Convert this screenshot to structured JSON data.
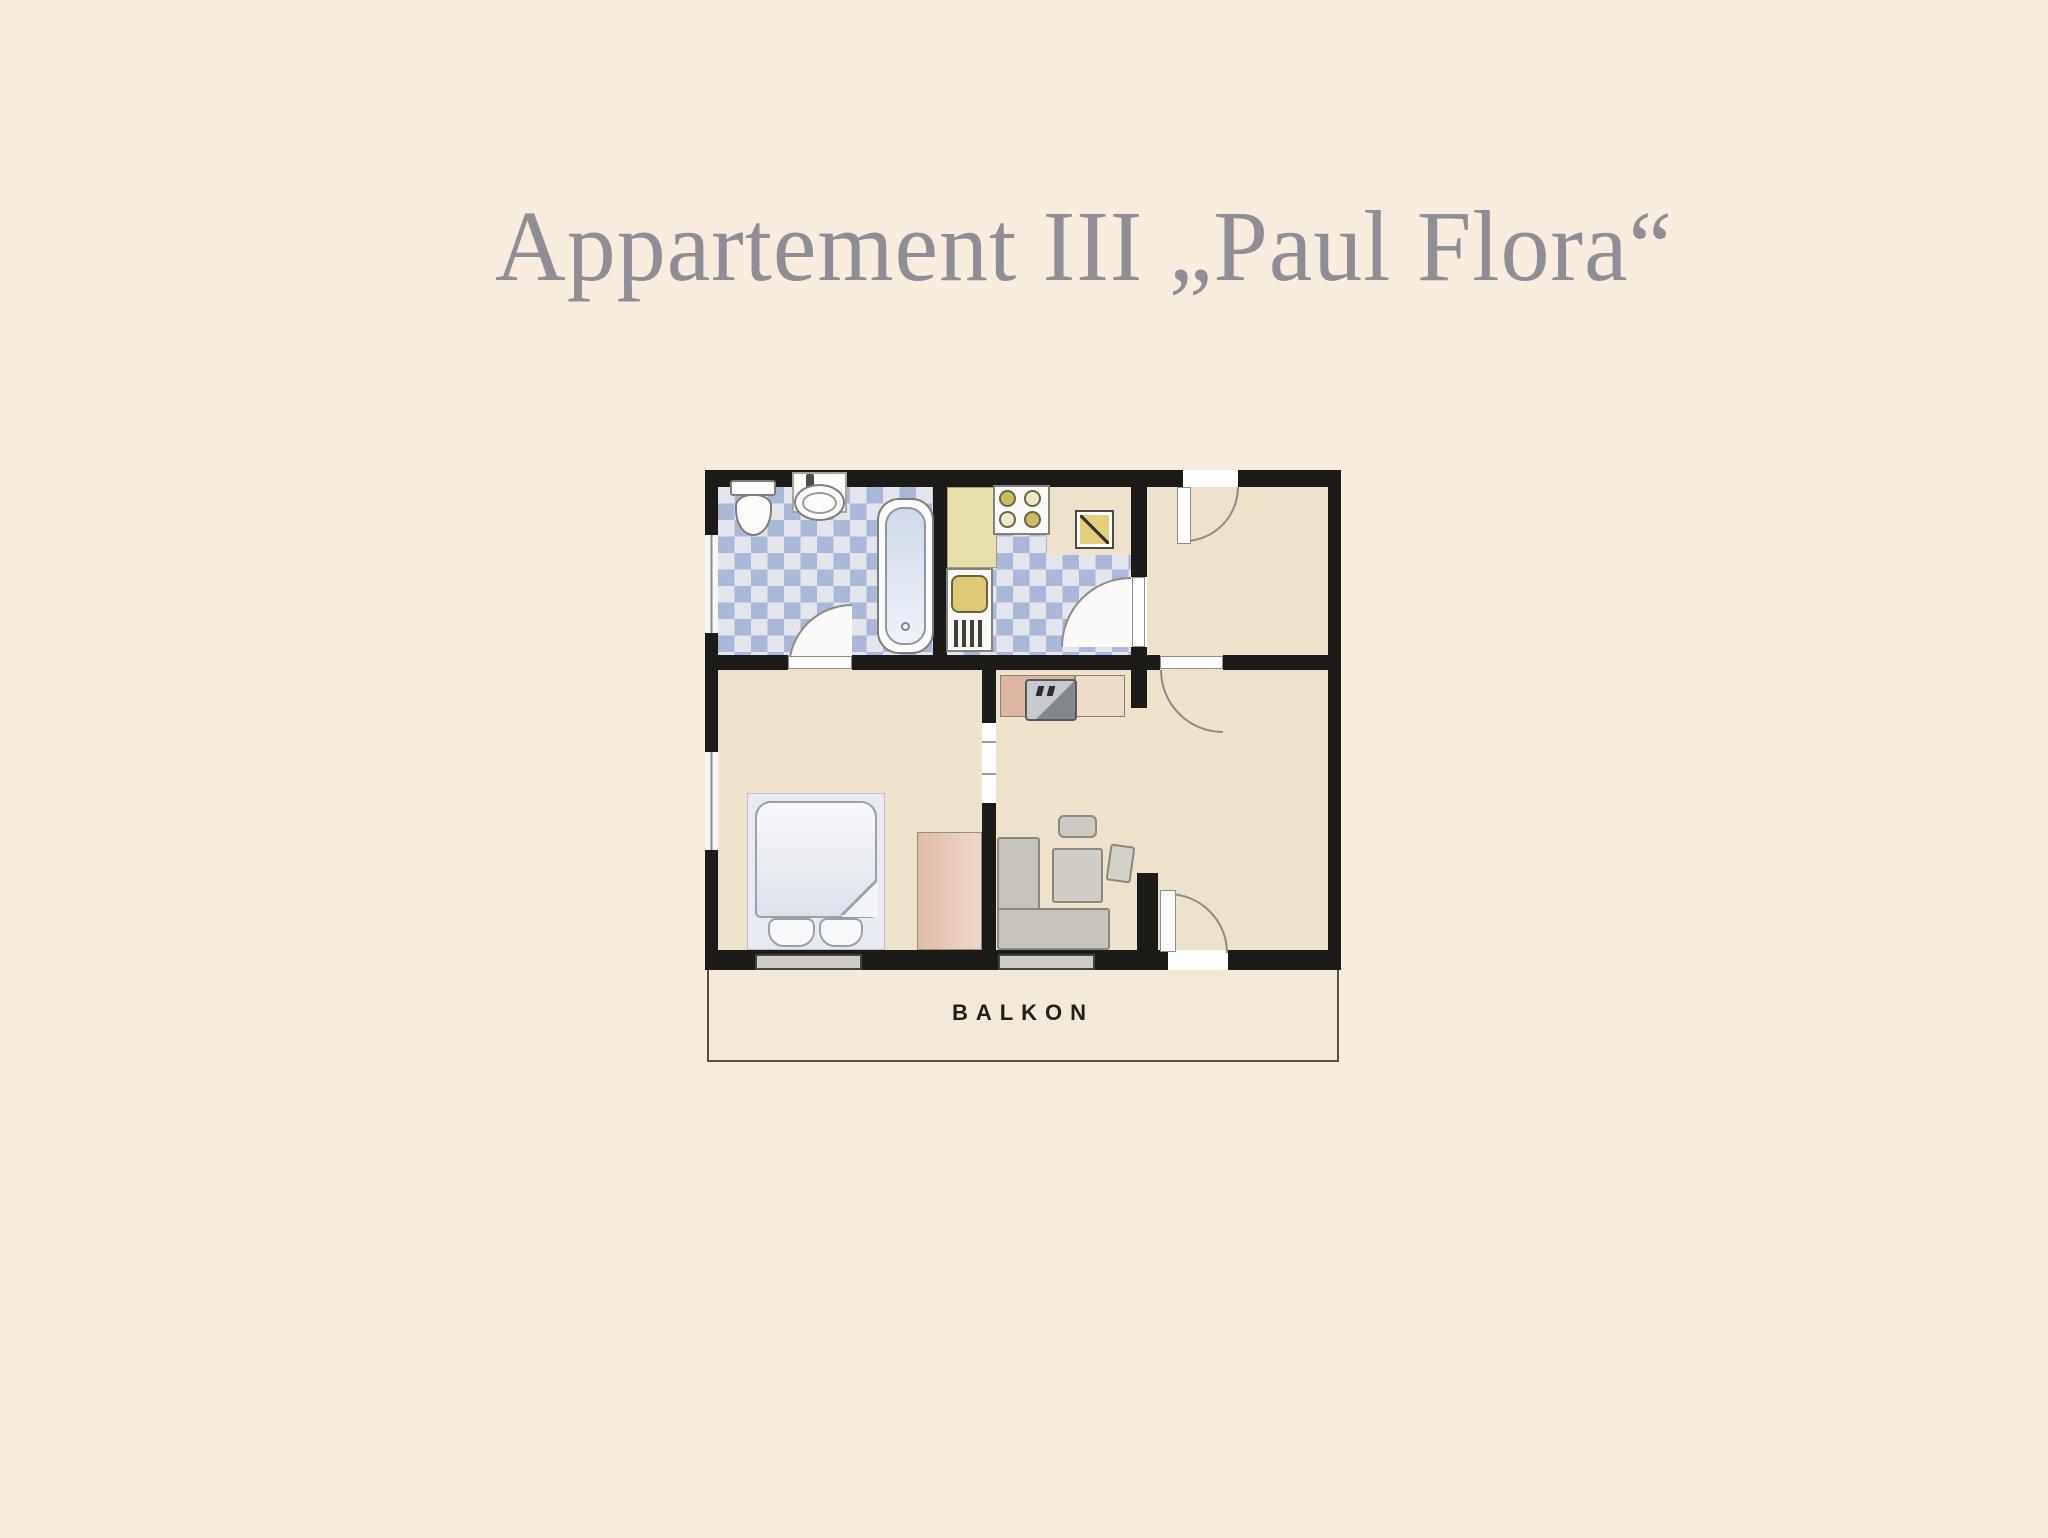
{
  "page": {
    "title": "Appartement III „Paul Flora“"
  },
  "plan": {
    "balcony_label": "BALKON",
    "rooms": [
      "bathroom",
      "kitchen",
      "entry-hall",
      "bedroom",
      "living-room",
      "balcony"
    ],
    "fixtures": [
      "toilet",
      "wash-basin",
      "bathtub",
      "kitchen-counter",
      "stove",
      "kitchen-sink",
      "kitchen-table",
      "tv-sideboard",
      "tv",
      "sofa",
      "coffee-table",
      "stool",
      "chair",
      "double-bed",
      "pillows",
      "wardrobe"
    ]
  },
  "colors": {
    "page_bg": "#f8ecdf",
    "title_color": "#8f8e94",
    "floor": "#efe2cd",
    "wall": "#1d1b18",
    "tile_blue": "#a9b7d8",
    "tile_light": "#e4e4ed",
    "counter": "#e8e0aa",
    "fixture_yellow": "#ddc873",
    "table_yellow": "#e5cf7d",
    "sideboard_pink": "#dbb5a0",
    "wardrobe": "#e0bda9",
    "sofa": "#c6c3ba",
    "bed": "#e7eaf0",
    "tub_blue": "#cfd9e8",
    "door_arc": "#8b8b8b",
    "balcony_bg": "#f3e9d9",
    "balcony_text": "#211f1c"
  }
}
